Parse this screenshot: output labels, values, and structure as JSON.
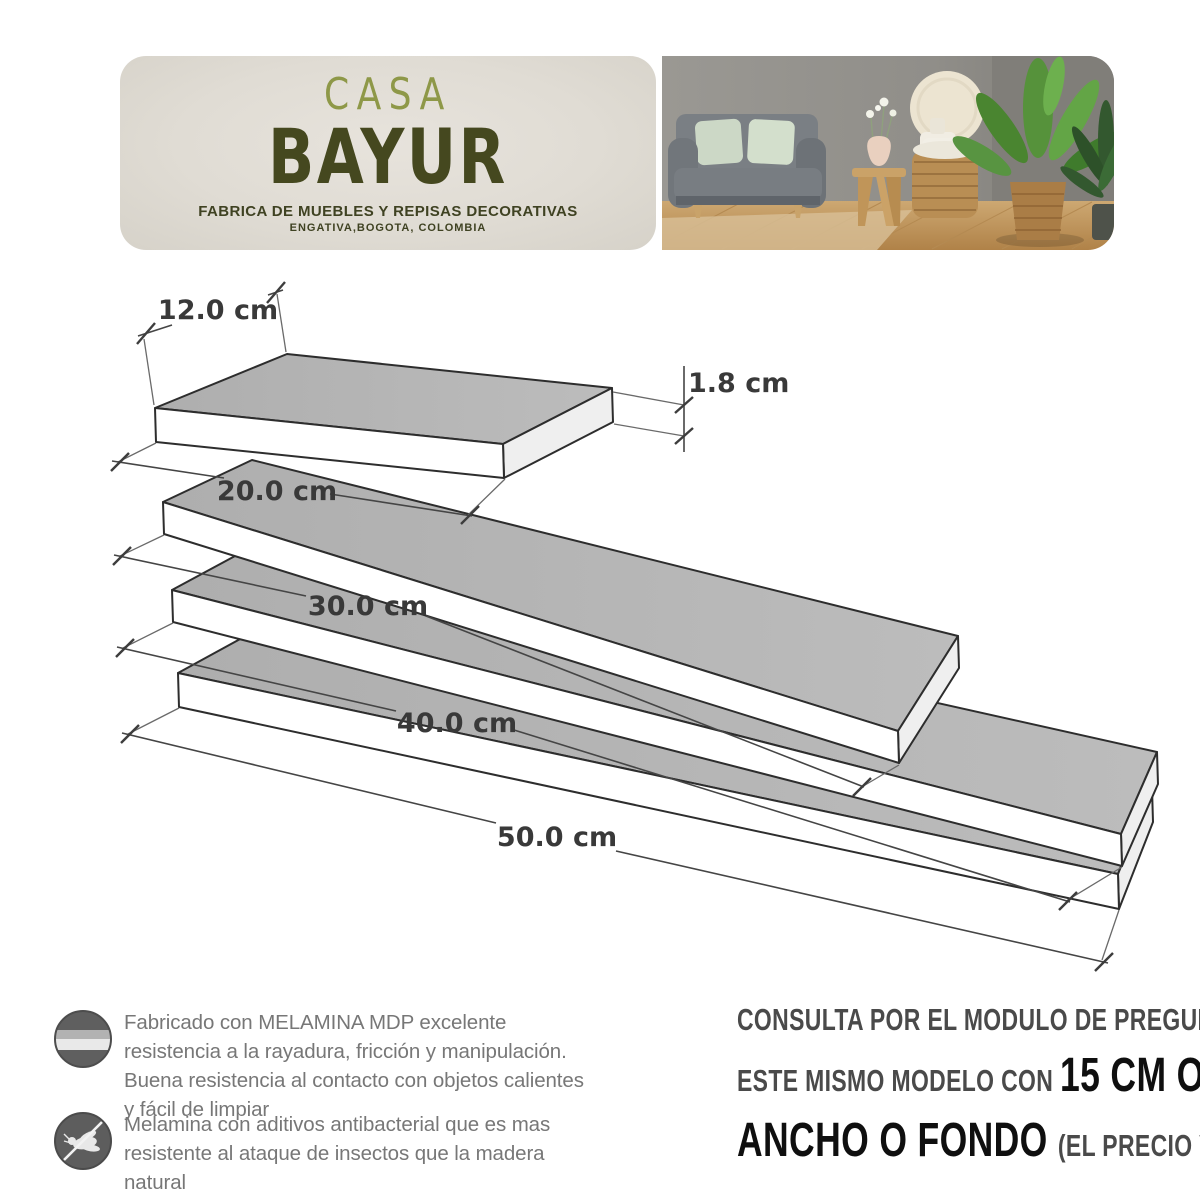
{
  "header": {
    "brand_top": "CASA",
    "brand_main": "BAYUR",
    "tagline": "FABRICA DE MUEBLES Y REPISAS DECORATIVAS",
    "location": "ENGATIVA,BOGOTA, COLOMBIA",
    "colors": {
      "panel_bg": "#e0dcd4",
      "brand_top": "#8e9848",
      "brand_main": "#45481f",
      "tagline_text": "#3f4222"
    }
  },
  "diagram": {
    "depth_label": "12.0 cm",
    "thickness_label": "1.8 cm",
    "length_labels": [
      "20.0 cm",
      "30.0 cm",
      "40.0 cm",
      "50.0 cm"
    ],
    "shelves": [
      {
        "length_cm": 20.0,
        "depth_cm": 12.0,
        "thickness_cm": 1.8
      },
      {
        "length_cm": 30.0,
        "depth_cm": 12.0,
        "thickness_cm": 1.8
      },
      {
        "length_cm": 40.0,
        "depth_cm": 12.0,
        "thickness_cm": 1.8
      },
      {
        "length_cm": 50.0,
        "depth_cm": 12.0,
        "thickness_cm": 1.8
      }
    ],
    "colors": {
      "top_face": "#b5b5b5",
      "front_face": "#ffffff",
      "end_face": "#efefef",
      "outline": "#2d2d2d",
      "dim_line": "#444444",
      "label_text": "#393939"
    }
  },
  "features": [
    {
      "icon": "melamine-layers-icon",
      "text": "Fabricado con MELAMINA MDP  excelente resistencia a la rayadura, fricción y manipulación. Buena resistencia al contacto con objetos calientes y fácil de limpiar"
    },
    {
      "icon": "no-insects-icon",
      "text": "Melamina con aditivos antibacterial que es mas resistente al ataque de insectos que la madera natural"
    }
  ],
  "cta": {
    "line1": "CONSULTA POR EL MODULO DE PREGUNTAS POR",
    "line2_regular": "ESTE MISMO MODELO CON ",
    "line2_bold": "15 CM O MAS DE",
    "line3_bold": "ANCHO O FONDO ",
    "line3_regular": "(EL PRECIO VARIA)"
  }
}
